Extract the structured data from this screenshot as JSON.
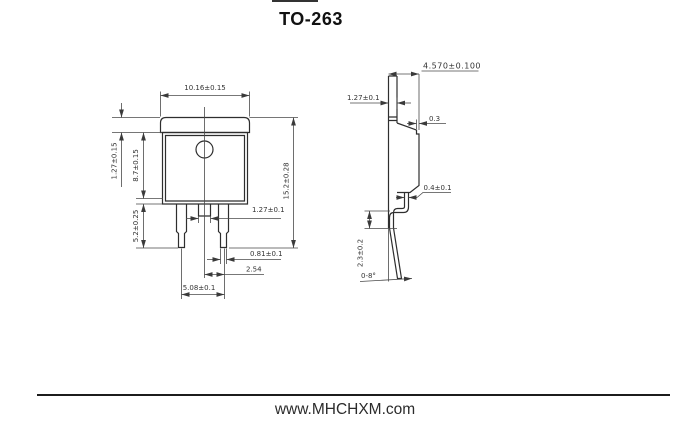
{
  "title": "TO-263",
  "front_view": {
    "dim_top_width": "10.16±0.15",
    "dim_tab_height": "1.27±0.15",
    "dim_body_height": "8.7±0.15",
    "dim_lead_length": "5.2±0.25",
    "dim_overall_height": "15.2±0.28",
    "dim_center_tab_width": "1.27±0.1",
    "dim_lead_width": "0.81±0.1",
    "dim_lead_pitch": "2.54",
    "dim_lead_span": "5.08±0.1"
  },
  "side_view": {
    "dim_overall_thickness": "4.570±0.100",
    "dim_tab_thickness": "1.27±0.1",
    "dim_body_step": "0.3",
    "dim_lead_thickness": "0.4±0.1",
    "dim_standoff_height": "2.3±0.2",
    "dim_lead_angle": "0-8°"
  },
  "footer": {
    "website": "www.MHCHXM.com"
  }
}
